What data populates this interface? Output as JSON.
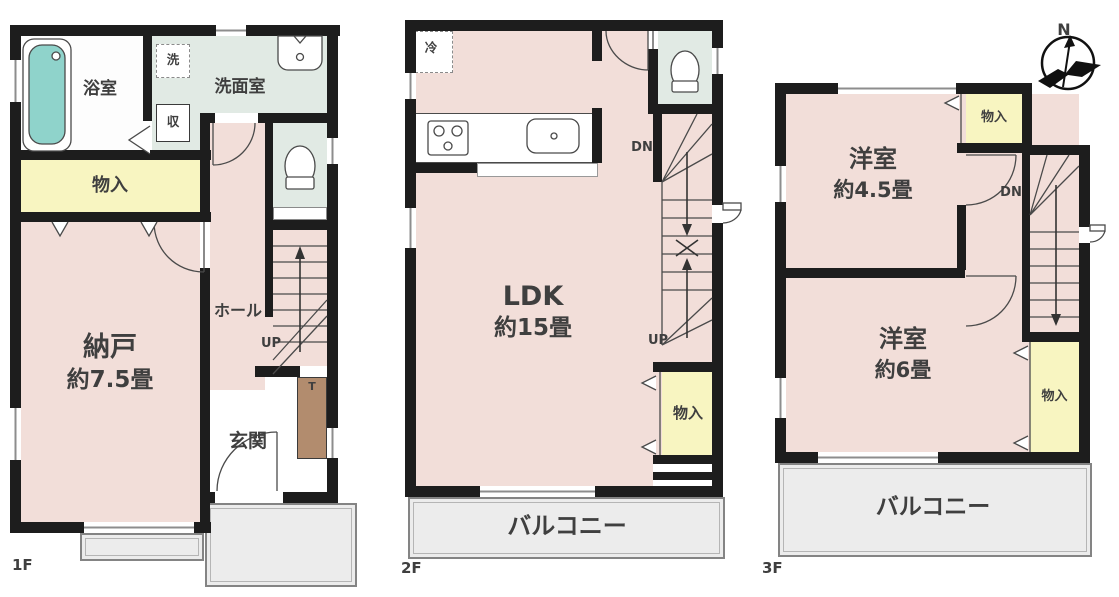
{
  "colors": {
    "wall": "#1d1d1d",
    "room_pink": "#f2ded9",
    "wet_area_green": "#e1eae4",
    "closet_yellow": "#f8f5c1",
    "balcony_gray": "#ececec",
    "bathtub_teal": "#8fd3cb",
    "cabinet_brown": "#b28c6e",
    "text": "#3f3f3f"
  },
  "f1": {
    "floor_label": "1F",
    "bathroom": "浴室",
    "washer": "洗",
    "washroom": "洗面室",
    "closet": "収",
    "storage": "物入",
    "nando": [
      "納戸",
      "約7.5畳"
    ],
    "hall": "ホール",
    "up": "UP",
    "cabinet": "T",
    "entrance": "玄関"
  },
  "f2": {
    "floor_label": "2F",
    "fridge": "冷",
    "dn": "DN",
    "ldk": [
      "LDK",
      "約15畳"
    ],
    "up": "UP",
    "storage": "物入",
    "balcony": "バルコニー"
  },
  "f3": {
    "floor_label": "3F",
    "storage_top": "物入",
    "room45": [
      "洋室",
      "約4.5畳"
    ],
    "dn": "DN",
    "room6": [
      "洋室",
      "約6畳"
    ],
    "storage_right": "物入",
    "balcony": "バルコニー",
    "compass_n": "N"
  }
}
